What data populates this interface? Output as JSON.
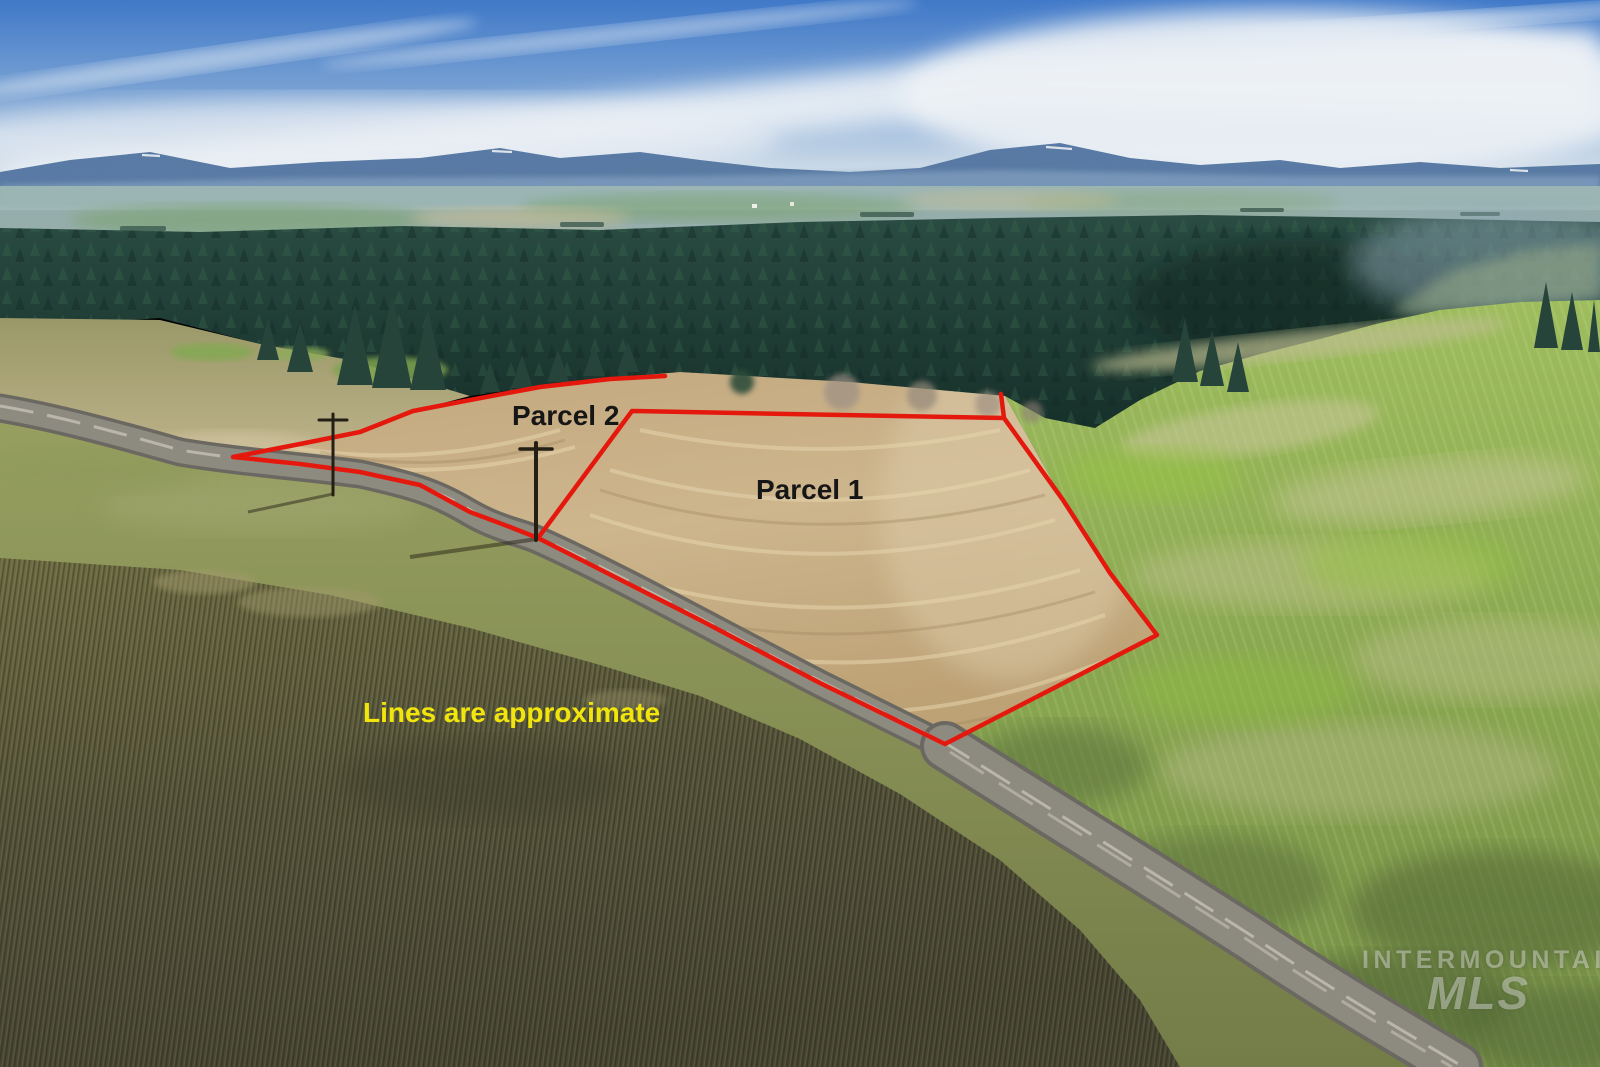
{
  "photo": {
    "description": "aerial-drone-photo-of-farmland-with-parcel-outlines",
    "labels": {
      "parcel1": "Parcel 1",
      "parcel2": "Parcel 2",
      "disclaimer": "Lines are approximate"
    },
    "watermark": {
      "line1": "INTERMOUNTAIN",
      "line2": "MLS"
    },
    "colors": {
      "boundary_red": "#e5180e",
      "parcel_label_text": "#161616",
      "disclaimer_yellow": "#f2e50c",
      "watermark_white": "#ffffff",
      "sky_blue": "#4079c8",
      "forest_green": "#1c3a30",
      "stubble_tan": "#c7ae85",
      "hill_green": "#8fae53",
      "plowed_olive": "#57553a",
      "road_gray": "#8d8a80"
    }
  }
}
